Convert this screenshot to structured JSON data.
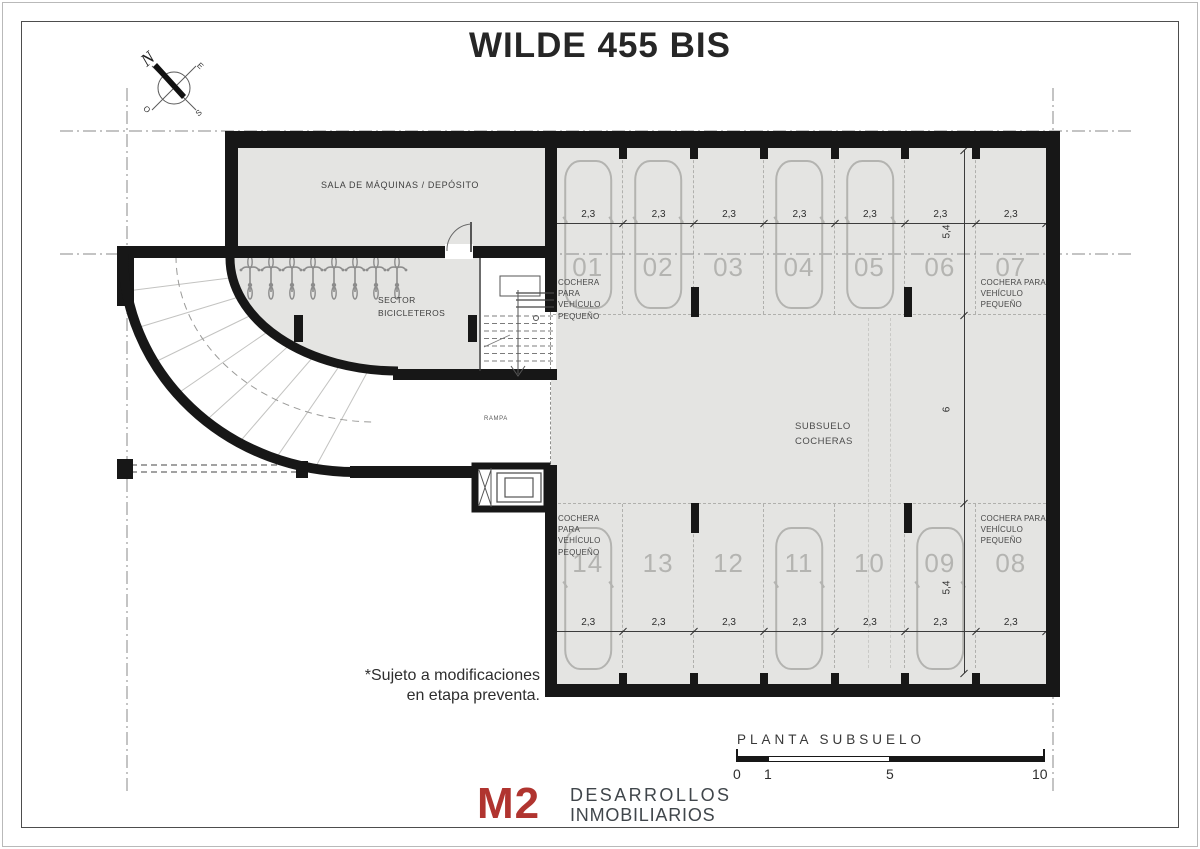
{
  "title": "WILDE 455 BIS",
  "compass": {
    "n": "N",
    "e": "E",
    "s": "S",
    "o": "O"
  },
  "rooms": {
    "sala_label": "SALA DE MÁQUINAS / DEPÓSITO",
    "bicicleteros_line1": "SECTOR",
    "bicicleteros_line2": "BICICLETEROS",
    "subsuelo_line1": "SUBSUELO",
    "subsuelo_line2": "COCHERAS",
    "rampa_label": "RAMPA"
  },
  "parking": {
    "small_note_lines": [
      "COCHERA PARA",
      "VEHÍCULO",
      "PEQUEÑO"
    ],
    "top_spots": [
      {
        "num": "01",
        "dim": "2,3",
        "car": true,
        "note": true
      },
      {
        "num": "02",
        "dim": "2,3",
        "car": true,
        "note": false
      },
      {
        "num": "03",
        "dim": "2,3",
        "car": false,
        "note": false
      },
      {
        "num": "04",
        "dim": "2,3",
        "car": true,
        "note": false
      },
      {
        "num": "05",
        "dim": "2,3",
        "car": true,
        "note": false
      },
      {
        "num": "06",
        "dim": "2,3",
        "car": false,
        "note": false
      },
      {
        "num": "07",
        "dim": "2,3",
        "car": false,
        "note": true
      }
    ],
    "bottom_spots": [
      {
        "num": "14",
        "dim": "2,3",
        "car": true,
        "note": true
      },
      {
        "num": "13",
        "dim": "2,3",
        "car": false,
        "note": false
      },
      {
        "num": "12",
        "dim": "2,3",
        "car": false,
        "note": false
      },
      {
        "num": "11",
        "dim": "2,3",
        "car": true,
        "note": false
      },
      {
        "num": "10",
        "dim": "2,3",
        "car": false,
        "note": false
      },
      {
        "num": "09",
        "dim": "2,3",
        "car": true,
        "note": false
      },
      {
        "num": "08",
        "dim": "2,3",
        "car": false,
        "note": true
      }
    ],
    "v_dims": [
      "5,4",
      "6",
      "5,4"
    ]
  },
  "footer": {
    "disclaimer_line1": "*Sujeto a modificaciones",
    "disclaimer_line2": "en etapa preventa.",
    "plan_label": "PLANTA SUBSUELO",
    "scale_ticks": [
      "0",
      "1",
      "5",
      "10"
    ],
    "logo_m2": "M2",
    "logo_line1": "DESARROLLOS",
    "logo_line2": "INMOBILIARIOS",
    "logo_color": "#b0342f"
  }
}
